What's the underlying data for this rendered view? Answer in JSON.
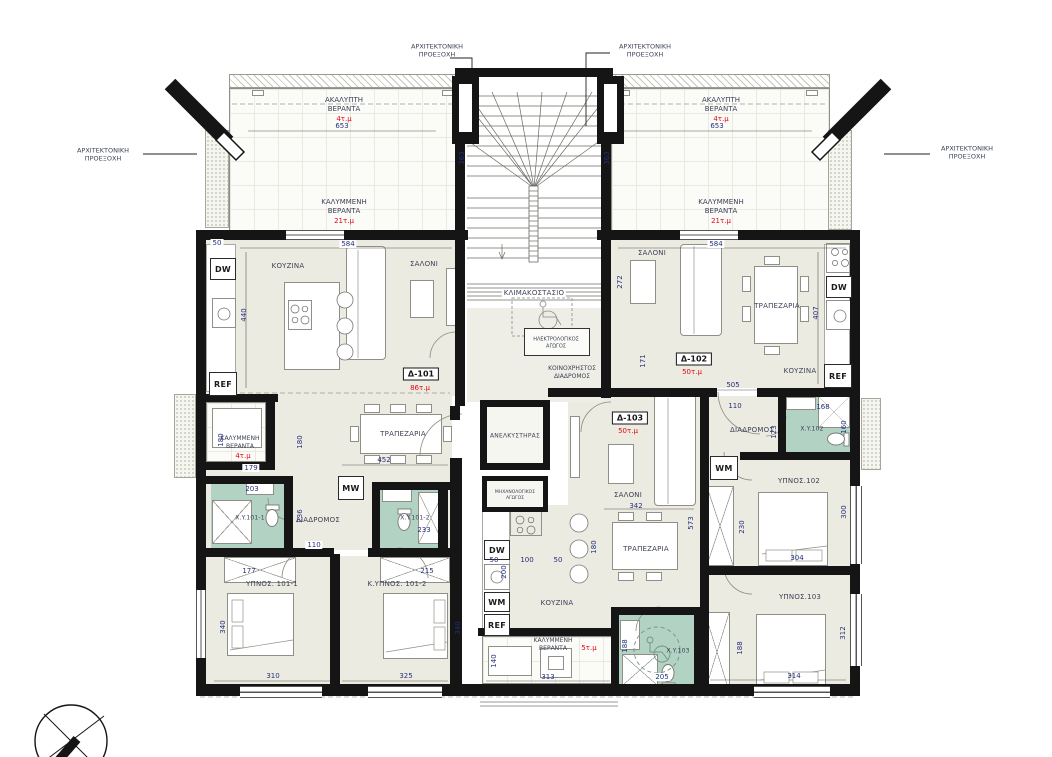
{
  "notes": {
    "callout": "ΑΡΧΙΤΕΚΤΟΝΙΚΗ ΠΡΟΕΞΟΧΗ"
  },
  "core": {
    "stairwell": "ΚΛΙΜΑΚΟΣΤΑΣΙΟ",
    "elevator": "ΑΝΕΛΚΥΣΤΗΡΑΣ",
    "electrical": "ΗΛΕΚΤΡΟΛΟΓΙΚΟΣ ΑΓΩΓΟΣ",
    "mechanical": "ΜΗΧΑΝΟΛΟΓΙΚΟΣ ΑΓΩΓΟΣ",
    "corridor": "ΚΟΙΝΟΧΡΗΣΤΟΣ ΔΙΑΔΡΟΜΟΣ"
  },
  "verandas": {
    "open": "ΑΚΑΛΥΠΤΗ ΒΕΡΑΝΤΑ",
    "covered": "ΚΑΛΥΜΜΕΝΗ ΒΕΡΑΝΤΑ",
    "open_area": "4τ.μ",
    "covered_area": "21τ.μ",
    "small_area": "4τ.μ",
    "bottom_area": "5τ.μ"
  },
  "apartments": {
    "d101": {
      "tag": "Δ-101",
      "area": "86τ.μ",
      "kitchen": "ΚΟΥΖΙΝΑ",
      "living": "ΣΑΛΟΝΙ",
      "dining": "ΤΡΑΠΕΖΑΡΙΑ",
      "hall": "ΔΙΑΔΡΟΜΟΣ",
      "bedroom1": "ΥΠΝΟΣ. 101-1",
      "bedroom2": "Κ.ΥΠΝΟΣ. 101-2",
      "bath1": "X.Y.101-1",
      "bath2": "X.Y.101-2"
    },
    "d102": {
      "tag": "Δ-102",
      "area": "50τ.μ",
      "living": "ΣΑΛΟΝΙ",
      "dining": "ΤΡΑΠΕΖΑΡΙΑ",
      "kitchen": "ΚΟΥΖΙΝΑ",
      "hall": "ΔΙΑΔΡΟΜΟΣ",
      "bedroom": "ΥΠΝΟΣ.102",
      "bath": "X.Y.102"
    },
    "d103": {
      "tag": "Δ-103",
      "area": "50τ.μ",
      "living": "ΣΑΛΟΝΙ",
      "dining": "ΤΡΑΠΕΖΑΡΙΑ",
      "kitchen": "ΚΟΥΖΙΝΑ",
      "bedroom": "ΥΠΝΟΣ.103",
      "bath": "X.Y.103"
    }
  },
  "appliances": {
    "dishwasher": "DW",
    "refrigerator": "REF",
    "washing_machine": "WM",
    "microwave": "MW"
  },
  "dims": {
    "vtl_w": "653",
    "vtl_d": "363",
    "vtr_w": "653",
    "vtr_d": "363",
    "d101_top": "584",
    "d101_off": "50",
    "d101_left": "440",
    "d101_dining_w": "452",
    "d101_dining_d": "180",
    "vl_w": "179",
    "vl_d": "180",
    "xy1011_w": "203",
    "xy1012_w": "233",
    "hall101_d": "236",
    "hall101_w": "110",
    "b1011_c": "177",
    "b1011_w": "310",
    "b1011_d": "340",
    "b1012_c": "215",
    "b1012_w": "325",
    "b1012_d": "340",
    "d102_top": "584",
    "d102_left": "272",
    "d102_right": "407",
    "d102_bot": "505",
    "d102_entry": "171",
    "hallr_w": "110",
    "hallr_d": "123",
    "xy102_w": "168",
    "xy102_d": "160",
    "b102_c": "230",
    "b102_w": "304",
    "b102_d": "300",
    "b103_c": "188",
    "b103_w": "314",
    "b103_d": "312",
    "d103_liv_w": "342",
    "d103_side": "573",
    "ck_a": "50",
    "ck_b": "100",
    "ck_c": "50",
    "ck_d": "200",
    "ck_e": "180",
    "xy103_w": "205",
    "xy103_s": "188",
    "vb_w": "313",
    "vb_d": "140"
  },
  "colors": {
    "wall": "#151515",
    "room_fill": "#ecebe2",
    "bath_fill": "#b2d2c4",
    "area_text": "#e30613",
    "dim_text": "#23307a"
  }
}
